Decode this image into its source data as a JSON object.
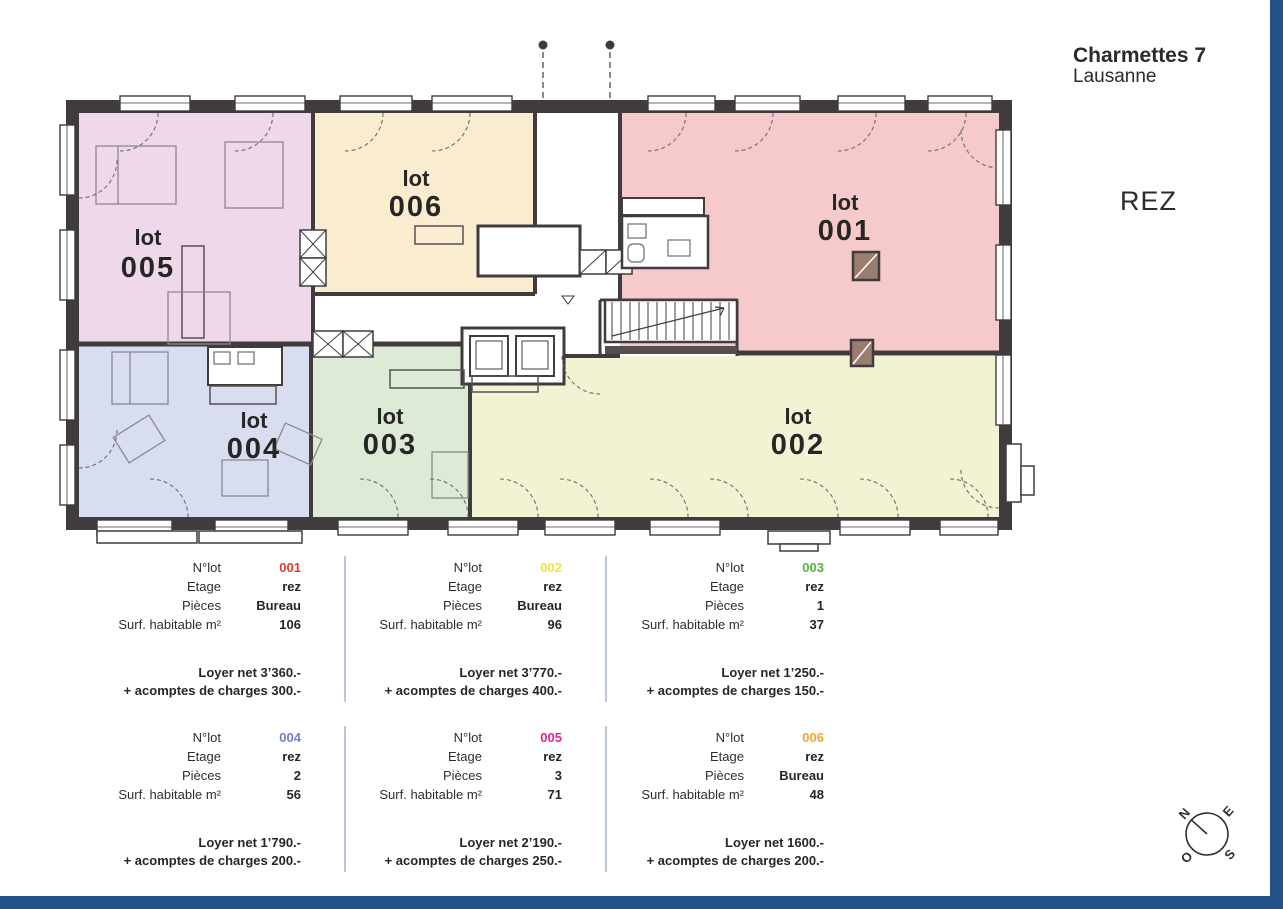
{
  "header": {
    "title": "Charmettes 7",
    "city": "Lausanne",
    "floor_label": "REZ"
  },
  "plan": {
    "label_word": "lot",
    "lots": [
      {
        "number": "001",
        "fill": "#f6caca",
        "accent": "#e23a33"
      },
      {
        "number": "002",
        "fill": "#f1f3d3",
        "accent": "#ece53a"
      },
      {
        "number": "003",
        "fill": "#dcead6",
        "accent": "#55b43c"
      },
      {
        "number": "004",
        "fill": "#d8ddef",
        "accent": "#6d7fd3"
      },
      {
        "number": "005",
        "fill": "#eed8ea",
        "accent": "#e7218e"
      },
      {
        "number": "006",
        "fill": "#faeccf",
        "accent": "#f3a730"
      }
    ]
  },
  "table_labels": {
    "lot": "N°lot",
    "floor": "Etage",
    "rooms": "Pièces",
    "surface": "Surf. habitable m²"
  },
  "units": [
    {
      "number": "001",
      "color": "#e23a33",
      "floor": "rez",
      "rooms": "Bureau",
      "surface": "106",
      "rent": "Loyer net 3’360.-",
      "charges": "+ acomptes de charges 300.-"
    },
    {
      "number": "002",
      "color": "#ece53a",
      "floor": "rez",
      "rooms": "Bureau",
      "surface": "96",
      "rent": "Loyer net 3’770.-",
      "charges": "+ acomptes de charges 400.-"
    },
    {
      "number": "003",
      "color": "#55b43c",
      "floor": "rez",
      "rooms": "1",
      "surface": "37",
      "rent": "Loyer net 1’250.-",
      "charges": "+ acomptes de charges 150.-"
    },
    {
      "number": "004",
      "color": "#6d7fd3",
      "floor": "rez",
      "rooms": "2",
      "surface": "56",
      "rent": "Loyer net 1’790.-",
      "charges": "+ acomptes de charges 200.-"
    },
    {
      "number": "005",
      "color": "#e7218e",
      "floor": "rez",
      "rooms": "3",
      "surface": "71",
      "rent": "Loyer net 2’190.-",
      "charges": "+ acomptes de charges 250.-"
    },
    {
      "number": "006",
      "color": "#f3a730",
      "floor": "rez",
      "rooms": "Bureau",
      "surface": "48",
      "rent": "Loyer net 1600.-",
      "charges": "+ acomptes de charges 200.-"
    }
  ],
  "compass": {
    "north": "N",
    "east": "E",
    "south": "S",
    "west": "O"
  },
  "colors": {
    "frame": "#235289",
    "wall": "#403c3e"
  }
}
